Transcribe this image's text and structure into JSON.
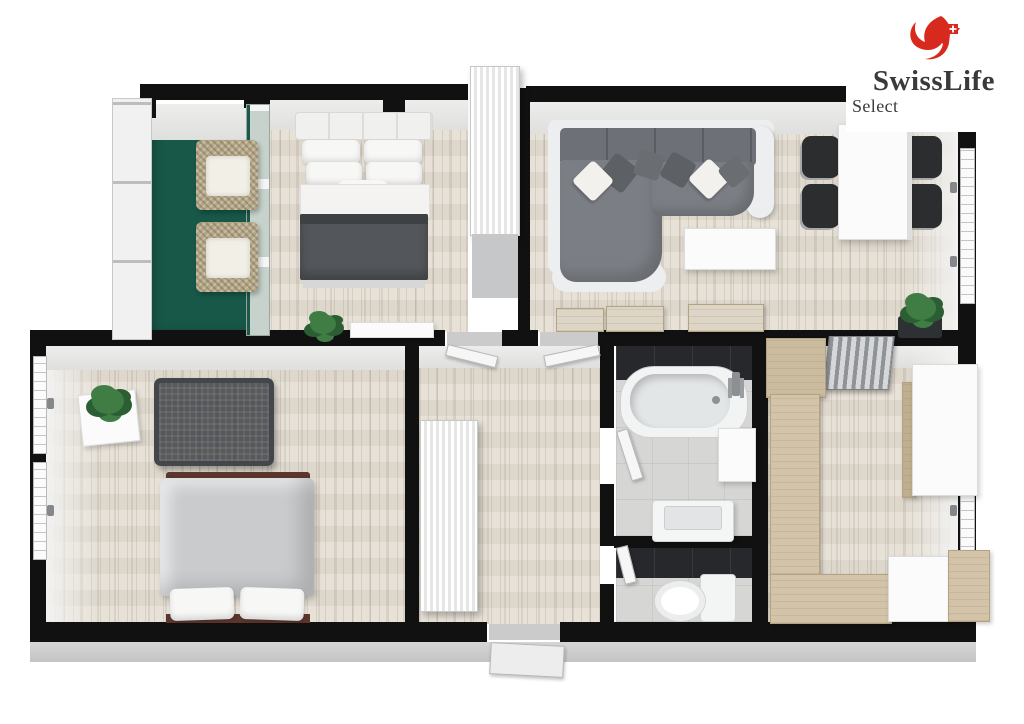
{
  "logo": {
    "brand": "SwissLife",
    "sub": "Select",
    "icon": "swisslife-swan-icon",
    "brand_color": "#d8291f",
    "text_color": "#3a3a3a"
  },
  "colors": {
    "wall": "#111111",
    "wood": "#e4ded3",
    "balcony": "#175848",
    "railing": "#f1f1f1",
    "sofa_back": "#6d7177",
    "sofa_seat": "#7b7f85",
    "sofa_trim": "#eceeef",
    "blanket": "#53565a",
    "duvet": "#c9cbcd",
    "bedframe": "#5c352d",
    "crib": "#43464a",
    "oak": "#d2c3a9",
    "oak_dark": "#b3a383",
    "tile": "#26282b",
    "bathfloor": "#d6d6d4",
    "face": "#e8e8e7",
    "green": "#3f7d44",
    "green_dark": "#2c5e33",
    "wicker": "#b4a787",
    "cushion": "#f2efe7",
    "radiator": "#8f9296",
    "chair": "#2b2d2f",
    "white_furn": "#fbfbfb",
    "text": "#3a3a3a",
    "brand_red": "#d8291f"
  }
}
